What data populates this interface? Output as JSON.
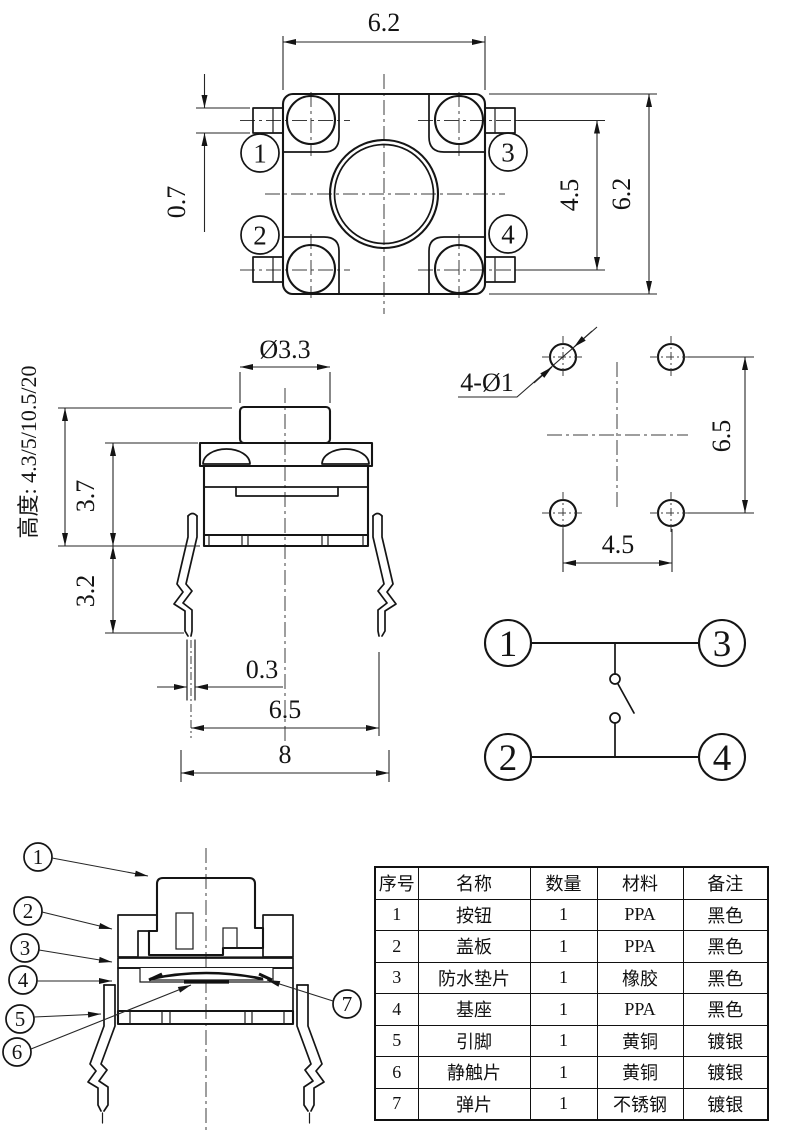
{
  "top_view": {
    "dim_width_top": "6.2",
    "dim_tab_height": "0.7",
    "dim_pin_row_span": "4.5",
    "dim_height_right": "6.2",
    "pin_labels": [
      "1",
      "2",
      "3",
      "4"
    ]
  },
  "side_view": {
    "dim_knob_diameter": "Ø3.3",
    "height_label": "高度: 4.3/5/10.5/20",
    "dim_body_height": "3.7",
    "dim_leg_length": "3.2",
    "dim_pin_thickness": "0.3",
    "dim_pin_pitch": "6.5",
    "dim_overall_width": "8"
  },
  "pcb_layout": {
    "hole_callout": "4-Ø1",
    "dim_vertical_pitch": "6.5",
    "dim_horizontal_pitch": "4.5"
  },
  "schematic": {
    "pin_labels": [
      "1",
      "2",
      "3",
      "4"
    ]
  },
  "section_view": {
    "callout_labels": [
      "1",
      "2",
      "3",
      "4",
      "5",
      "6",
      "7"
    ]
  },
  "parts_table": {
    "headers": [
      "序号",
      "名称",
      "数量",
      "材料",
      "备注"
    ],
    "rows": [
      [
        "1",
        "按钮",
        "1",
        "PPA",
        "黑色"
      ],
      [
        "2",
        "盖板",
        "1",
        "PPA",
        "黑色"
      ],
      [
        "3",
        "防水垫片",
        "1",
        "橡胶",
        "黑色"
      ],
      [
        "4",
        "基座",
        "1",
        "PPA",
        "黑色"
      ],
      [
        "5",
        "引脚",
        "1",
        "黄铜",
        "镀银"
      ],
      [
        "6",
        "静触片",
        "1",
        "黄铜",
        "镀银"
      ],
      [
        "7",
        "弹片",
        "1",
        "不锈钢",
        "镀银"
      ]
    ]
  }
}
